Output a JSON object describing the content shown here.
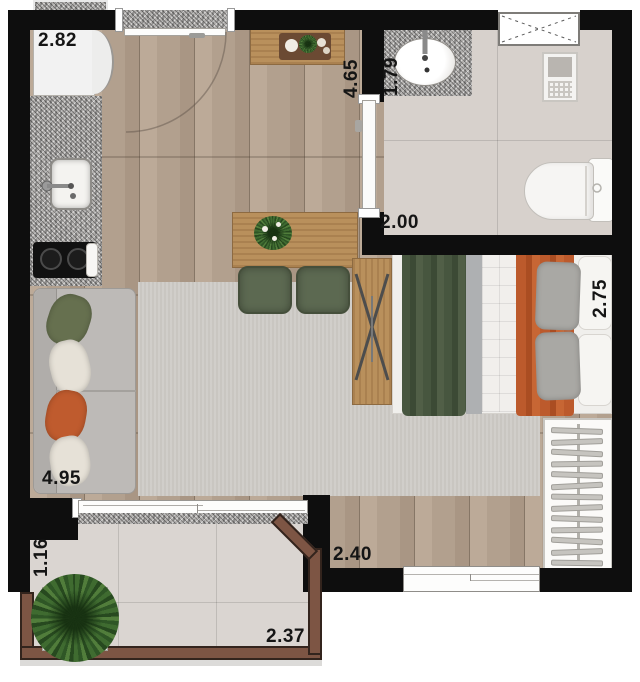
{
  "dimensions": {
    "kitchen_wall": "2.82",
    "entry_hall_length": "4.65",
    "bathroom_counter_width": "1.79",
    "bathroom_width": "2.00",
    "bedroom_depth": "2.75",
    "living_room_length": "4.95",
    "bedroom_width": "2.40",
    "balcony_depth": "1.16",
    "balcony_width": "2.37"
  },
  "colors": {
    "wall": "#0e0e0e",
    "wood_floor": "#b3a08f",
    "rug": "#c9c6c1",
    "tile": "#d7d1cc",
    "granite": "#b2b0ae",
    "furniture_wood": "#b9905c",
    "chair_green": "#5c6951",
    "bed_blanket_green": "#44523d",
    "bed_blanket_orange": "#b85526",
    "sofa_gray": "#bdbab7",
    "railing_brown": "#7d5544",
    "plant_green": "#3f6b30"
  }
}
